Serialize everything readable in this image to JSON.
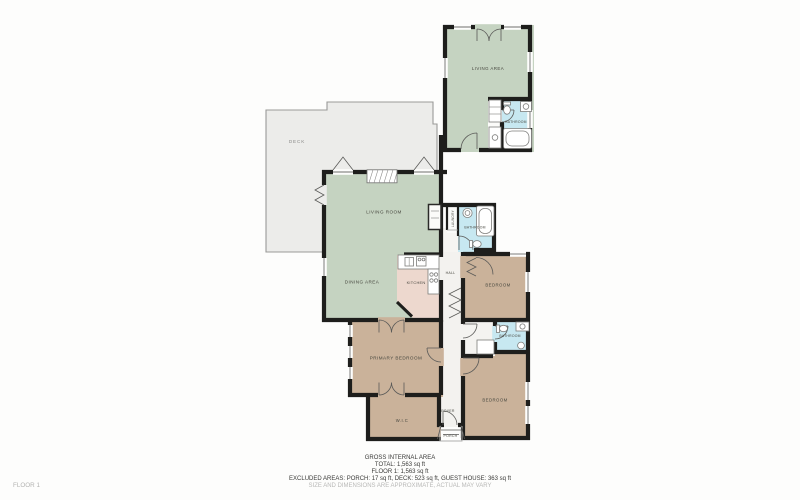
{
  "floorplan": {
    "floor_label": "FLOOR 1",
    "rooms": {
      "deck": "DECK",
      "guest_living_area": "LIVING AREA",
      "guest_bathroom": "BATHROOM",
      "living_room": "LIVING ROOM",
      "dining_area": "DINING AREA",
      "kitchen": "KITCHEN",
      "hall": "HALL",
      "laundry": "LAUNDRY",
      "bathroom_main": "BATHROOM",
      "bedroom_right": "BEDROOM",
      "bathroom_small": "BATHROOM",
      "bedroom_lower": "BEDROOM",
      "primary_bedroom": "PRIMARY BEDROOM",
      "wic": "W.I.C",
      "foyer": "FOYER",
      "porch": "PORCH"
    },
    "summary": {
      "title": "GROSS INTERNAL AREA",
      "total": "TOTAL: 1,563 sq ft",
      "floor1": "FLOOR 1: 1,563 sq ft",
      "excluded": "EXCLUDED AREAS: PORCH: 17 sq ft, DECK: 523 sq ft, GUEST HOUSE: 363 sq ft",
      "disclaimer": "SIZE AND DIMENSIONS ARE APPROXIMATE, ACTUAL MAY VARY"
    },
    "colors": {
      "living_green": "#c5d3c1",
      "bedroom_tan": "#cab29a",
      "bathroom_blue": "#c7e8f1",
      "kitchen_pink": "#edd8ce",
      "deck_gray": "#ececea",
      "hall_white": "#f3f2ef",
      "wall_black": "#1e1e1c"
    }
  }
}
